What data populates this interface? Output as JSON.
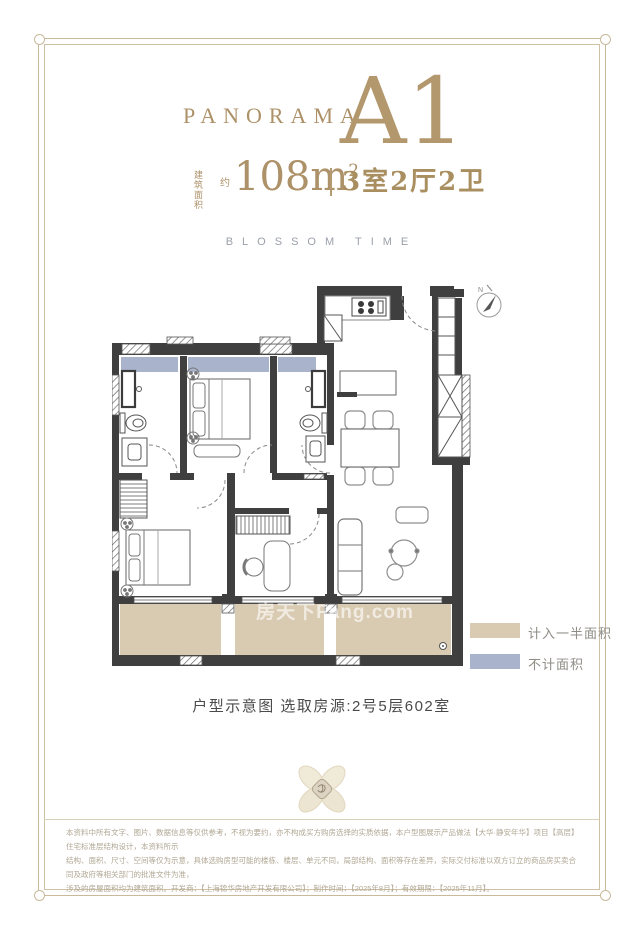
{
  "header": {
    "brand": "PANORAMA",
    "unit_code": "A1",
    "area_label_top": "建筑",
    "area_label_bottom": "面积",
    "area_approx": "约",
    "area_value": "108m",
    "area_sup": "2",
    "layout_rooms": "3室2厅2卫",
    "tagline": "BLOSSOM TIME",
    "accent_color": "#ad9168"
  },
  "floorplan": {
    "compass_label": "N",
    "watermark": "房天下Fang.com",
    "legend": [
      {
        "label": "计入一半面积",
        "color": "#d9cab2"
      },
      {
        "label": "不计面积",
        "color": "#a9b3cb"
      }
    ]
  },
  "caption": "户型示意图  选取房源:2号5层602室",
  "disclaimer": {
    "line1": "本资料中所有文字、图片、数据信息等仅供参考，不视为要约，亦不构成买方购房选择的实质依据，本户型图展示产品做法【大华·静安年华】项目【高层】住宅标准层结构设计，本资料所示",
    "line2": "结构、面积、尺寸、空间等仅为示意，具体选购房型可能的楼栋、楼层、单元不同，局部结构、面积等存在差异，实际交付标准以双方订立的商品房买卖合同及政府等相关部门的批准文件为准，",
    "line3": "涉及的房屋面积均为建筑面积。开发商：【上海锦华房地产开发有限公司】；制作时间：【2025年8月】；有效期限：【2025年11月】。"
  }
}
